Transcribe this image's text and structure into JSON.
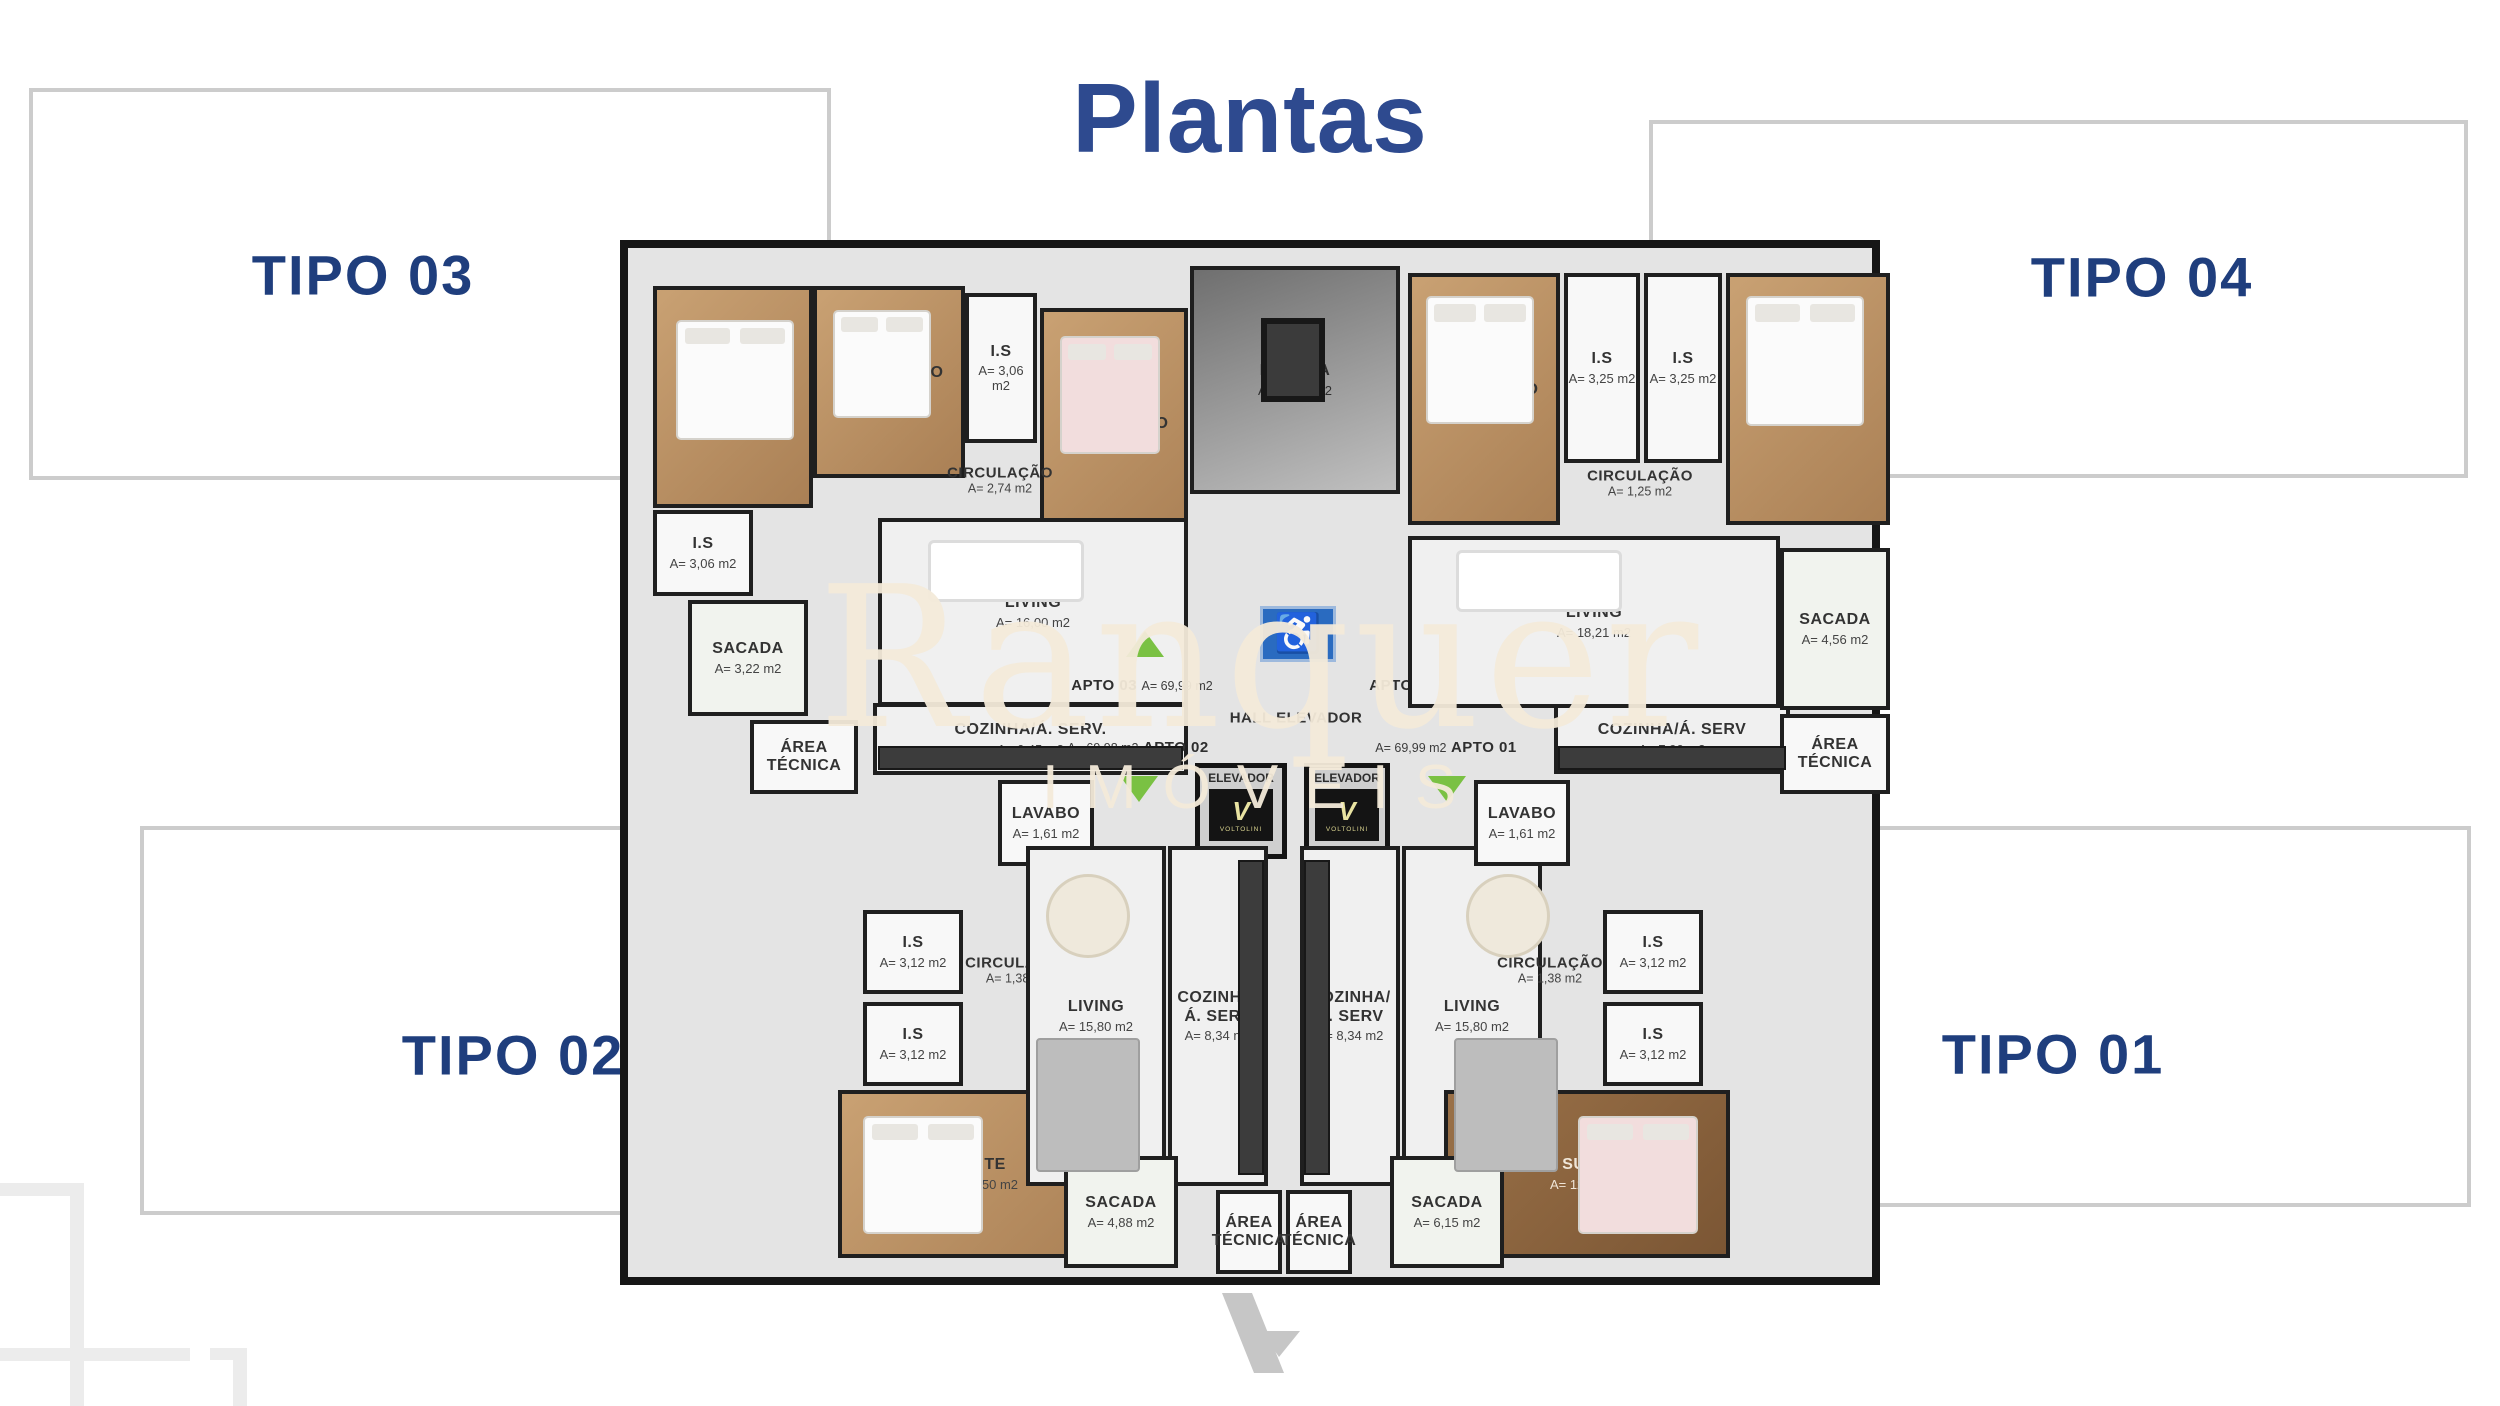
{
  "title": "Plantas",
  "tipos": {
    "t03": "TIPO 03",
    "t04": "TIPO 04",
    "t02": "TIPO 02",
    "t01": "TIPO 01"
  },
  "watermark": {
    "brand": "Ranquer",
    "subtitle": "IMÓVEIS"
  },
  "units": {
    "apto03": {
      "name": "APTO 03",
      "area": "A= 69,99 m2"
    },
    "apto04": {
      "name": "APTO 04",
      "area": "A= 69,99 m2"
    },
    "apto02": {
      "name": "APTO 02",
      "area": "A= 69,98 m2"
    },
    "apto01": {
      "name": "APTO 01",
      "area": "A= 69,99 m2"
    }
  },
  "core": {
    "escada": {
      "name": "ESCADA",
      "area": "A= 12,50 m2"
    },
    "hall": {
      "name": "HALL ELEVADOR"
    },
    "elevador": {
      "name": "ELEVADOR",
      "brand": "VOLTOLINI",
      "v": "V"
    },
    "accessibility_icon": "♿"
  },
  "rooms": {
    "tl_suite": {
      "name": "SUITE",
      "area": "A= 10,71 m2"
    },
    "tl_dorm": {
      "name": "DORMITÓRIO",
      "area": "A= 7,96 m2"
    },
    "tl_dorm2": {
      "name": "DORMITÓRIO",
      "area": "A= 7,96 m2"
    },
    "tl_is1": {
      "name": "I.S",
      "area": "A= 3,06 m2"
    },
    "tl_is2": {
      "name": "I.S",
      "area": "A= 3,06 m2"
    },
    "tl_circ": {
      "name": "CIRCULAÇÃO",
      "area": "A= 2,74 m2"
    },
    "tl_living": {
      "name": "LIVING",
      "area": "A= 16,00 m2"
    },
    "tl_cozinha": {
      "name": "COZINHA/Á. SERV.",
      "area": "A= 6,45 m2"
    },
    "tl_sacada": {
      "name": "SACADA",
      "area": "A= 3,22 m2"
    },
    "tl_area": {
      "name": "ÁREA\nTÉCNICA",
      "area": ""
    },
    "tr_dorm": {
      "name": "DORMITÓRIO",
      "area": "A= 10,31 m2"
    },
    "tr_suite": {
      "name": "SUITE",
      "area": "A= 11,34 m2"
    },
    "tr_is1": {
      "name": "I.S",
      "area": "A= 3,25 m2"
    },
    "tr_is2": {
      "name": "I.S",
      "area": "A= 3,25 m2"
    },
    "tr_circ": {
      "name": "CIRCULAÇÃO",
      "area": "A= 1,25 m2"
    },
    "tr_living": {
      "name": "LIVING",
      "area": "A= 18,21 m2"
    },
    "tr_cozinha": {
      "name": "COZINHA/Á. SERV",
      "area": "A= 7,90 m2"
    },
    "tr_sacada": {
      "name": "SACADA",
      "area": "A= 4,56 m2"
    },
    "tr_area": {
      "name": "ÁREA\nTÉCNICA",
      "area": ""
    },
    "bl_lavabo": {
      "name": "LAVABO",
      "area": "A= 1,61 m2"
    },
    "bl_circ": {
      "name": "CIRCULAÇÃO",
      "area": "A= 1,38 m2"
    },
    "bl_is1": {
      "name": "I.S",
      "area": "A= 3,12 m2"
    },
    "bl_is2": {
      "name": "I.S",
      "area": "A= 3,12 m2"
    },
    "bl_suite": {
      "name": "SUITE",
      "area": "A= 12,50 m2"
    },
    "bl_living": {
      "name": "LIVING",
      "area": "A= 15,80 m2"
    },
    "bl_cozinha": {
      "name": "COZINHA/Á. SERV",
      "area": "A= 8,34 m2"
    },
    "bl_sacada": {
      "name": "SACADA",
      "area": "A= 4,88 m2"
    },
    "bl_area": {
      "name": "ÁREA\nTÉCNICA",
      "area": ""
    },
    "br_lavabo": {
      "name": "LAVABO",
      "area": "A= 1,61 m2"
    },
    "br_circ": {
      "name": "CIRCULAÇÃO",
      "area": "A= 1,38 m2"
    },
    "br_is1": {
      "name": "I.S",
      "area": "A= 3,12 m2"
    },
    "br_is2": {
      "name": "I.S",
      "area": "A= 3,12 m2"
    },
    "br_suite": {
      "name": "SUITE",
      "area": "A= 12,50 m2"
    },
    "br_living": {
      "name": "LIVING",
      "area": "A= 15,80 m2"
    },
    "br_cozinha": {
      "name": "COZINHA/Á. SERV",
      "area": "A= 8,34 m2"
    },
    "br_sacada": {
      "name": "SACADA",
      "area": "A= 6,15 m2"
    },
    "br_area": {
      "name": "ÁREA\nTÉCNICA",
      "area": ""
    }
  },
  "colors": {
    "title_blue": "#2e4a8f",
    "tipo_blue": "#1f3e7d",
    "watermark_cream": "#f3ead9",
    "entry_green": "#7ac143",
    "accessibility_blue": "#2a6bc0",
    "logo_gray": "#c6c6c6"
  }
}
